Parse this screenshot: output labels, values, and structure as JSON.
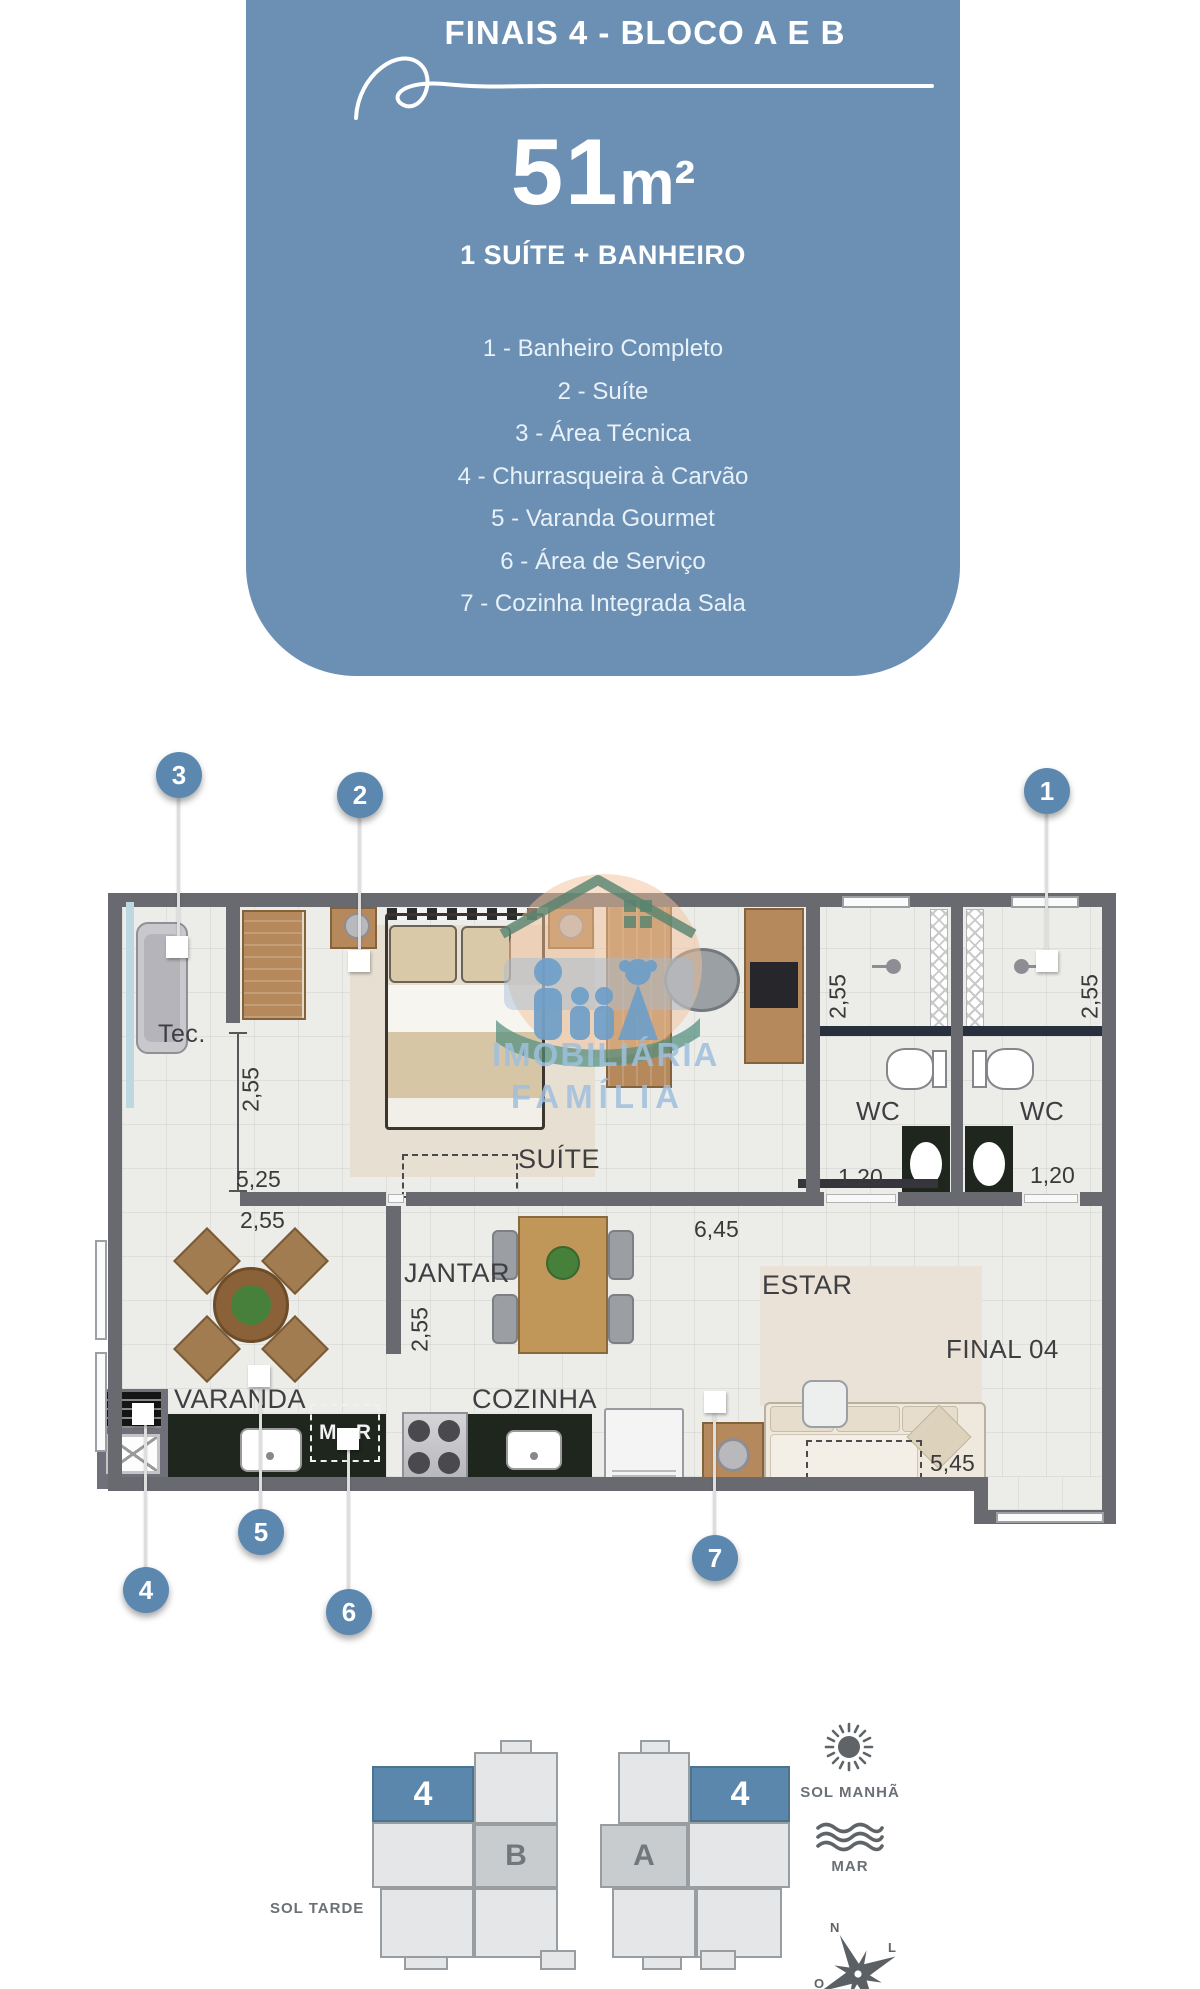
{
  "colors": {
    "card_blue": "#6C90B4",
    "marker_blue": "#5C88AF",
    "unit_blue": "#5B87AD",
    "wall_gray": "#696970",
    "counter_dark": "#1E261D",
    "label_gray": "#3F3F42",
    "footer_gray": "#6A7076"
  },
  "card": {
    "title": "FINAIS 4 - BLOCO A E B",
    "area_value": "51",
    "area_unit": "m²",
    "subtitle": "1 SUÍTE + BANHEIRO",
    "legend": [
      "1 - Banheiro Completo",
      "2 - Suíte",
      "3 - Área Técnica",
      "4 - Churrasqueira à Carvão",
      "5 - Varanda Gourmet",
      "6 - Área de Serviço",
      "7 - Cozinha Integrada Sala"
    ]
  },
  "plan": {
    "markers": {
      "m1": "1",
      "m2": "2",
      "m3": "3",
      "m4": "4",
      "m5": "5",
      "m6": "6",
      "m7": "7"
    },
    "rooms": {
      "tec": "Tec.",
      "suite": "SUÍTE",
      "wc_left": "WC",
      "wc_right": "WC",
      "jantar": "JANTAR",
      "cozinha": "COZINHA",
      "varanda": "VARANDA",
      "estar": "ESTAR"
    },
    "labels": {
      "final_unit": "FINAL 04",
      "mlr_left": "M.",
      "mlr_right": "R"
    },
    "dims": {
      "corridor_h": "2,55",
      "suite_w": "5,25",
      "varanda_w": "2,55",
      "jantar_h": "2,55",
      "hall_w": "6,45",
      "wc_left_h": "2,55",
      "wc_right_h": "2,55",
      "wc_left_w": "1,20",
      "wc_right_w": "1,20",
      "estar_w": "5,45"
    }
  },
  "watermark": {
    "line1": "IMOBILIÁRIA",
    "line2": "FAMÍLIA"
  },
  "footer": {
    "block_b": {
      "unit": "4",
      "label": "B"
    },
    "block_a": {
      "unit": "4",
      "label": "A"
    },
    "sol_tarde": "SOL TARDE",
    "sol_manha": "SOL MANHÃ",
    "mar": "MAR",
    "compass": {
      "n": "N",
      "l": "L",
      "o": "O"
    }
  }
}
